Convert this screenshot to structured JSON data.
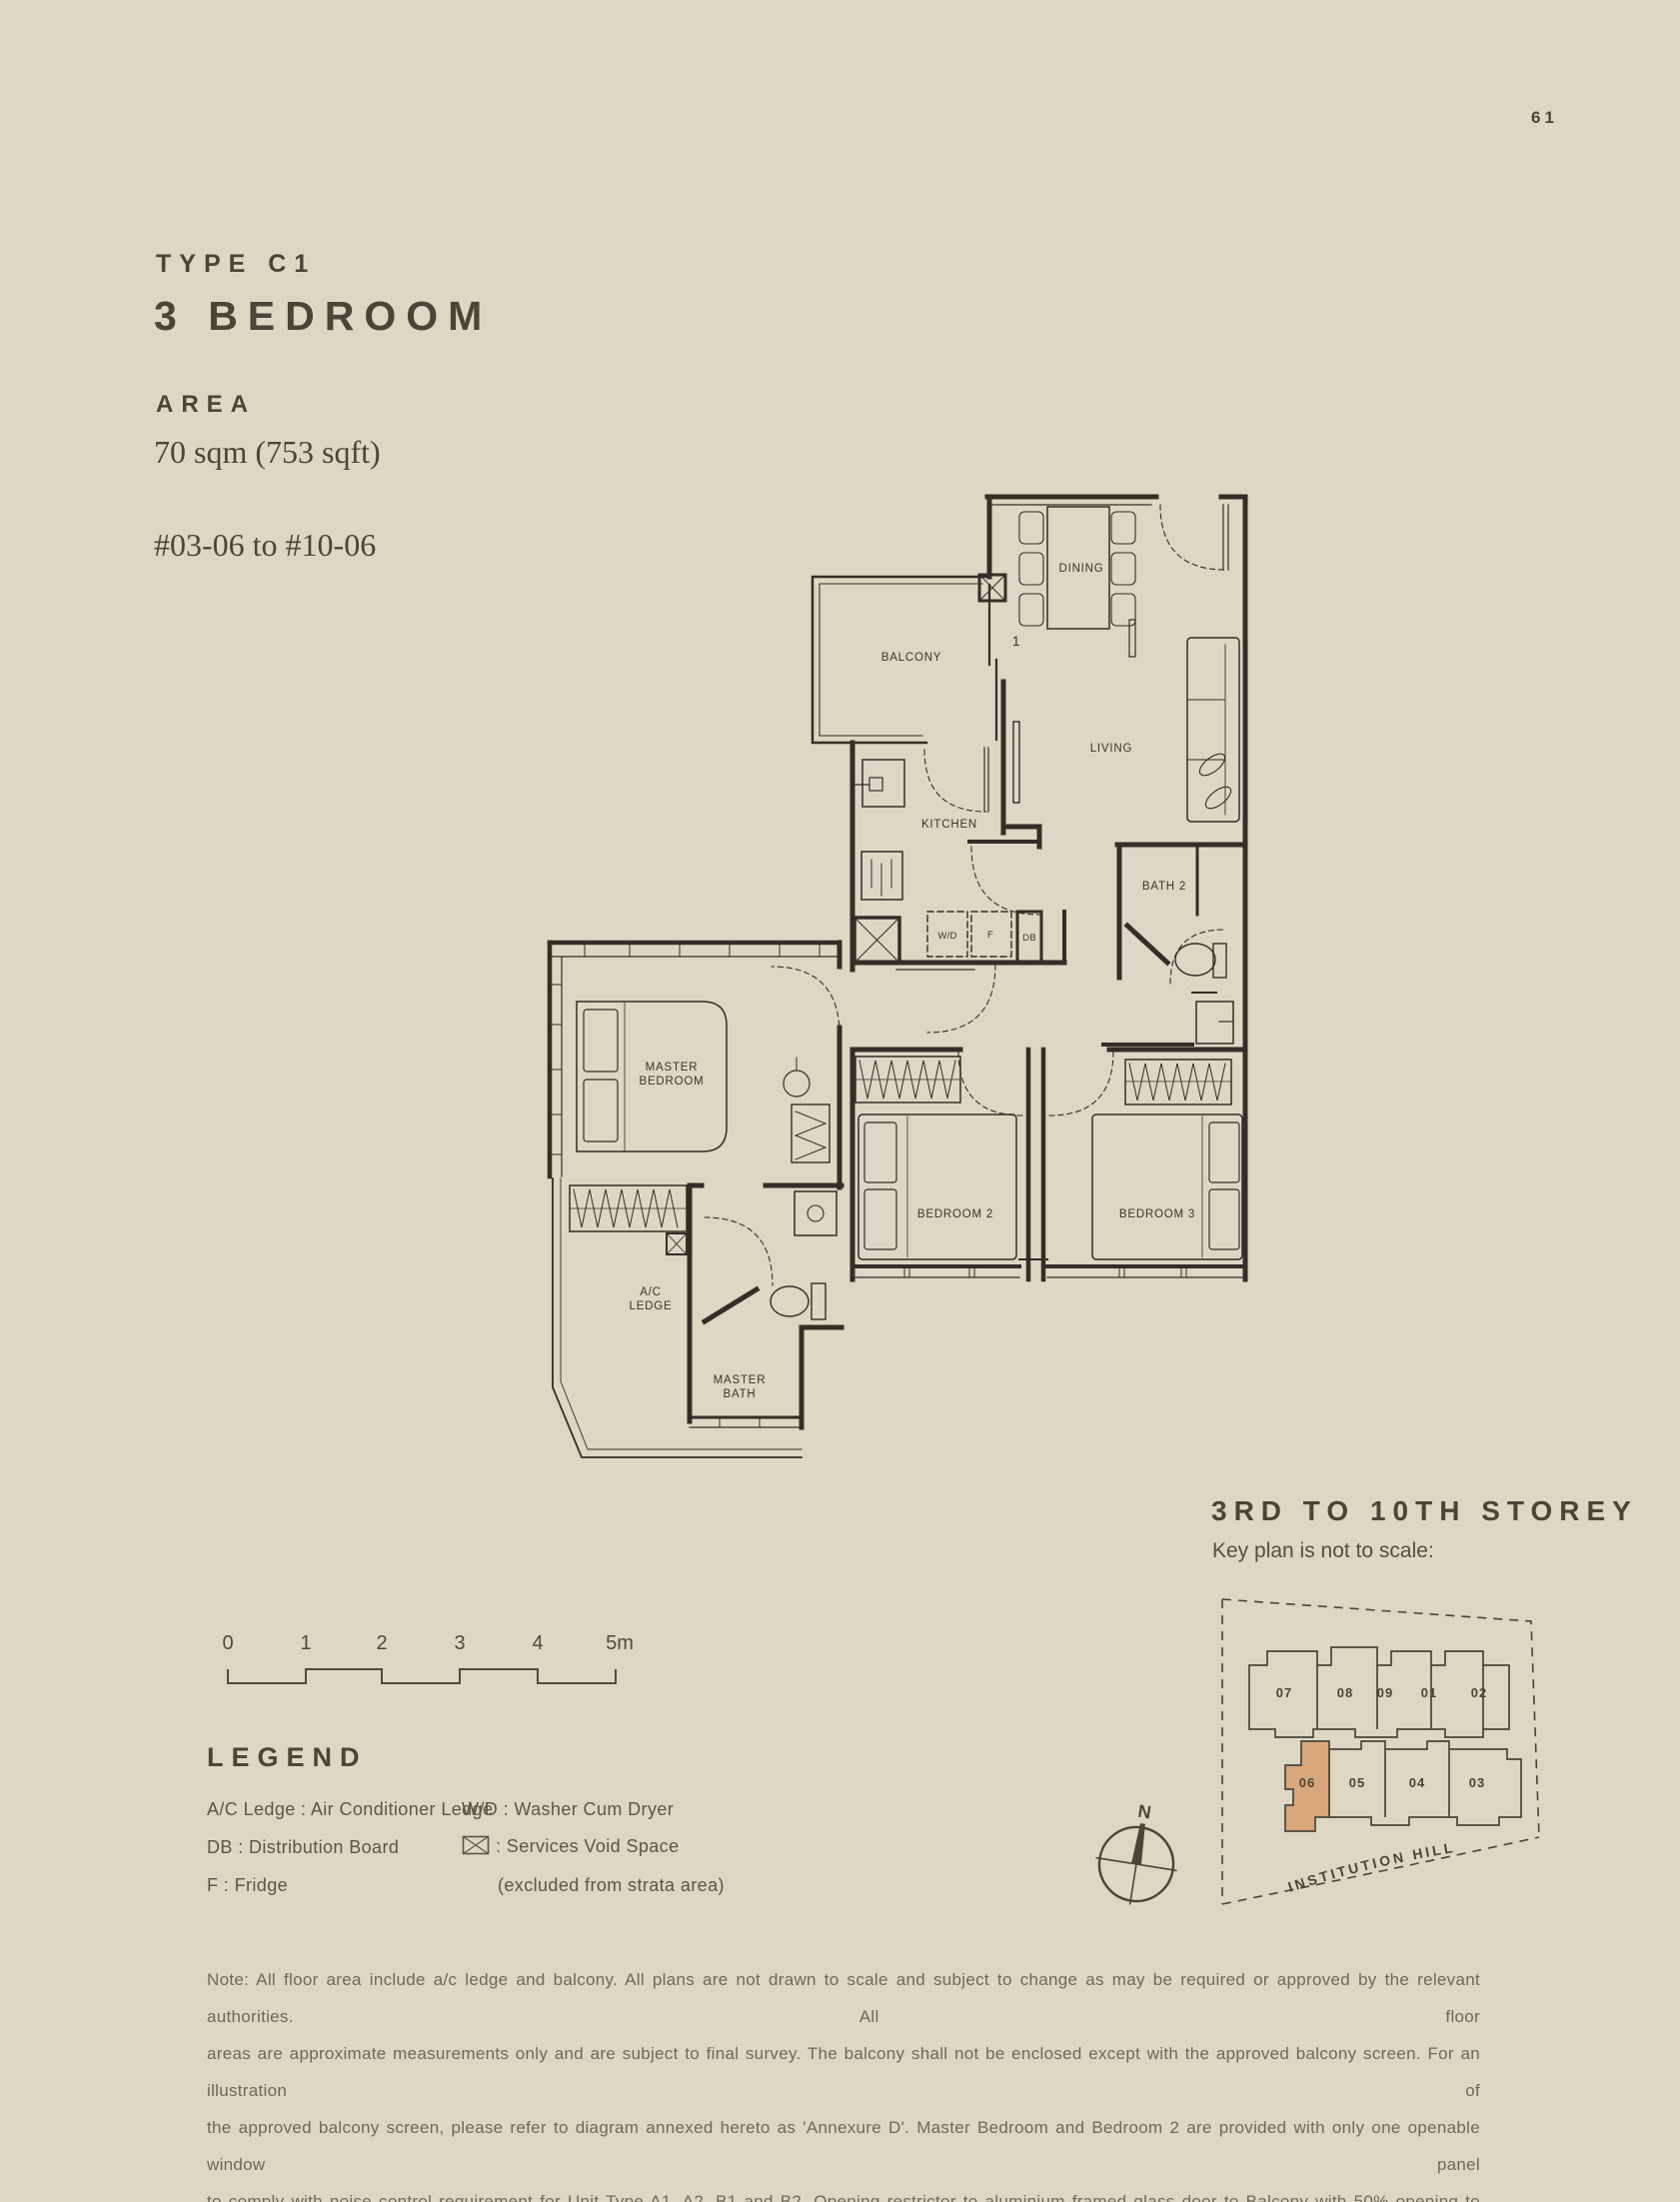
{
  "page": {
    "number": "61",
    "background": "#ddd7c4",
    "ink": "#4b4539",
    "accent": "#d9a77c"
  },
  "header": {
    "type_label": "TYPE C1",
    "unit_type": "3 BEDROOM",
    "area_label": "AREA",
    "area_value": "70 sqm (753 sqft)",
    "unit_range": "#03-06 to #10-06"
  },
  "plan": {
    "labels": {
      "dining": "DINING",
      "balcony": "BALCONY",
      "living": "LIVING",
      "kitchen": "KITCHEN",
      "bath2": "BATH 2",
      "wd": "W/D",
      "f": "F",
      "db": "DB",
      "master_1": "MASTER",
      "master_2": "BEDROOM",
      "bedroom2": "BEDROOM 2",
      "bedroom3": "BEDROOM 3",
      "ac_1": "A/C",
      "ac_2": "LEDGE",
      "mbath_1": "MASTER",
      "mbath_2": "BATH",
      "one": "1"
    }
  },
  "scalebar": {
    "ticks": [
      "0",
      "1",
      "2",
      "3",
      "4",
      "5m"
    ]
  },
  "legend": {
    "title": "LEGEND",
    "column1": [
      "A/C Ledge : Air Conditioner Ledge",
      "DB : Distribution Board",
      "F : Fridge"
    ],
    "column2": {
      "wd": "W/D : Washer Cum Dryer",
      "void_label": ": Services Void Space",
      "void_note": "(excluded from strata area)"
    }
  },
  "keyplan": {
    "title": "3RD TO 10TH STOREY",
    "subtitle": "Key plan is not to scale:",
    "north": "N",
    "road": "INSTITUTION HILL",
    "top_units": [
      "07",
      "08",
      "09",
      "01",
      "02"
    ],
    "bottom_units": [
      "06",
      "05",
      "04",
      "03"
    ],
    "highlighted_unit": "06"
  },
  "note": {
    "lines": [
      "Note: All floor area include a/c ledge and balcony. All plans are not drawn to scale and subject to change as may be required or approved by the relevant authorities. All floor",
      "areas are approximate measurements only and are subject to final survey. The balcony shall not be enclosed except with the approved balcony screen. For an illustration of",
      "the approved balcony screen, please refer to diagram annexed hereto as 'Annexure D'. Master Bedroom and Bedroom 2 are provided with only one openable window panel",
      "to comply with noise control requirement for Unit Type A1, A2, B1 and B2. Opening restrictor to aluminium framed glass door to Balcony with 50% opening to comply with",
      "noise control requirement for Unit Type A1, A2, B1 and B2."
    ]
  }
}
